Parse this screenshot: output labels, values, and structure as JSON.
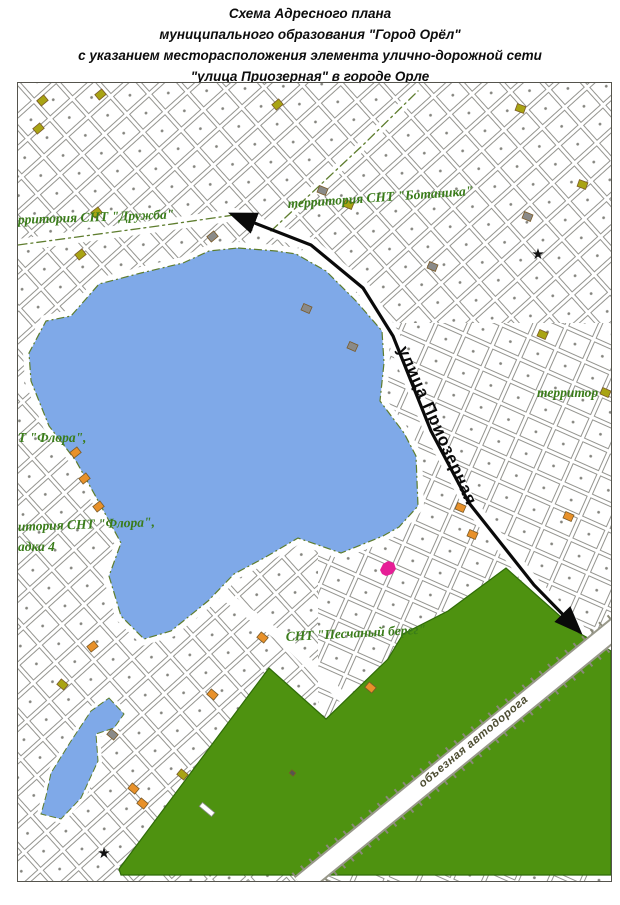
{
  "title": {
    "line1": "Схема Адресного плана",
    "line2": "муниципального образования \"Город Орёл\"",
    "line3": "с указанием месторасположения элемента улично-дорожной сети",
    "line4": "\"улица Приозерная\" в городе Орле"
  },
  "map": {
    "labels": {
      "druzhba": "рритория СНТ \"Дружба\"",
      "botanika": "территория СНТ \"Ботаника\"",
      "flora_short": "Т \"Флора\",",
      "flora_line1": "итория СНТ \"Флора\",",
      "flora_line2": "адка 4",
      "territor": "территор",
      "peschany": "СНТ \"Песчаный берег\"",
      "street": "улица Приозерная",
      "bypass_road": "объезная автодорога"
    },
    "colors": {
      "lake": "#7fa9e8",
      "forest": "#4e9210",
      "label_green": "#3a7c1a",
      "parcel_line": "#91918d",
      "boundary_olive": "#5e7d2e",
      "arrow_black": "#0a0a0a",
      "marker_magenta": "#e61e96"
    },
    "star_glyph": "★",
    "marker": {
      "x": 368,
      "y": 486
    },
    "stars": [
      {
        "x": 520,
        "y": 176
      },
      {
        "x": 86,
        "y": 775
      }
    ],
    "buildings": [
      {
        "x": 20,
        "y": 14,
        "c": "#a9a414",
        "r": -40
      },
      {
        "x": 78,
        "y": 8,
        "c": "#a9a414",
        "r": -40
      },
      {
        "x": 16,
        "y": 42,
        "c": "#a9a414",
        "r": -40
      },
      {
        "x": 74,
        "y": 126,
        "c": "#a9a414",
        "r": -38
      },
      {
        "x": 58,
        "y": 168,
        "c": "#a9a414",
        "r": -38
      },
      {
        "x": 326,
        "y": 118,
        "c": "#a9a414",
        "r": 22
      },
      {
        "x": 498,
        "y": 22,
        "c": "#a9a414",
        "r": 20
      },
      {
        "x": 560,
        "y": 98,
        "c": "#a9a414",
        "r": 20
      },
      {
        "x": 520,
        "y": 248,
        "c": "#a9a414",
        "r": 24
      },
      {
        "x": 583,
        "y": 306,
        "c": "#a9a414",
        "r": 24
      },
      {
        "x": 255,
        "y": 18,
        "c": "#a9a414",
        "r": -40
      },
      {
        "x": 160,
        "y": 688,
        "c": "#a9a414",
        "r": 40
      },
      {
        "x": 40,
        "y": 598,
        "c": "#a9a414",
        "r": 40
      },
      {
        "x": 53,
        "y": 366,
        "c": "#e8912a",
        "r": -38
      },
      {
        "x": 62,
        "y": 392,
        "c": "#e8912a",
        "r": -38
      },
      {
        "x": 76,
        "y": 420,
        "c": "#e8912a",
        "r": -38
      },
      {
        "x": 70,
        "y": 560,
        "c": "#e8912a",
        "r": -38
      },
      {
        "x": 190,
        "y": 608,
        "c": "#e8912a",
        "r": 40
      },
      {
        "x": 111,
        "y": 702,
        "c": "#e8912a",
        "r": 40
      },
      {
        "x": 120,
        "y": 717,
        "c": "#e8912a",
        "r": 40
      },
      {
        "x": 240,
        "y": 551,
        "c": "#e8912a",
        "r": 40
      },
      {
        "x": 348,
        "y": 601,
        "c": "#e8912a",
        "r": 40
      },
      {
        "x": 438,
        "y": 421,
        "c": "#e8912a",
        "r": 24
      },
      {
        "x": 450,
        "y": 448,
        "c": "#e8912a",
        "r": 24
      },
      {
        "x": 546,
        "y": 430,
        "c": "#e8912a",
        "r": 24
      },
      {
        "x": 284,
        "y": 222,
        "c": "#8a8a88",
        "r": 24
      },
      {
        "x": 300,
        "y": 104,
        "c": "#8a8a88",
        "r": 22
      },
      {
        "x": 190,
        "y": 150,
        "c": "#8a8a88",
        "r": -40
      },
      {
        "x": 330,
        "y": 260,
        "c": "#8a8a88",
        "r": 24
      },
      {
        "x": 90,
        "y": 648,
        "c": "#8a8a88",
        "r": 40
      },
      {
        "x": 410,
        "y": 180,
        "c": "#8a8a88",
        "r": 22
      },
      {
        "x": 505,
        "y": 130,
        "c": "#8a8a88",
        "r": 22
      },
      {
        "x": 272,
        "y": 688,
        "c": "#555550",
        "r": 40,
        "w": 5,
        "h": 4
      },
      {
        "x": 181,
        "y": 724,
        "c": "#ffffff",
        "r": 40,
        "w": 16,
        "h": 5
      }
    ]
  }
}
